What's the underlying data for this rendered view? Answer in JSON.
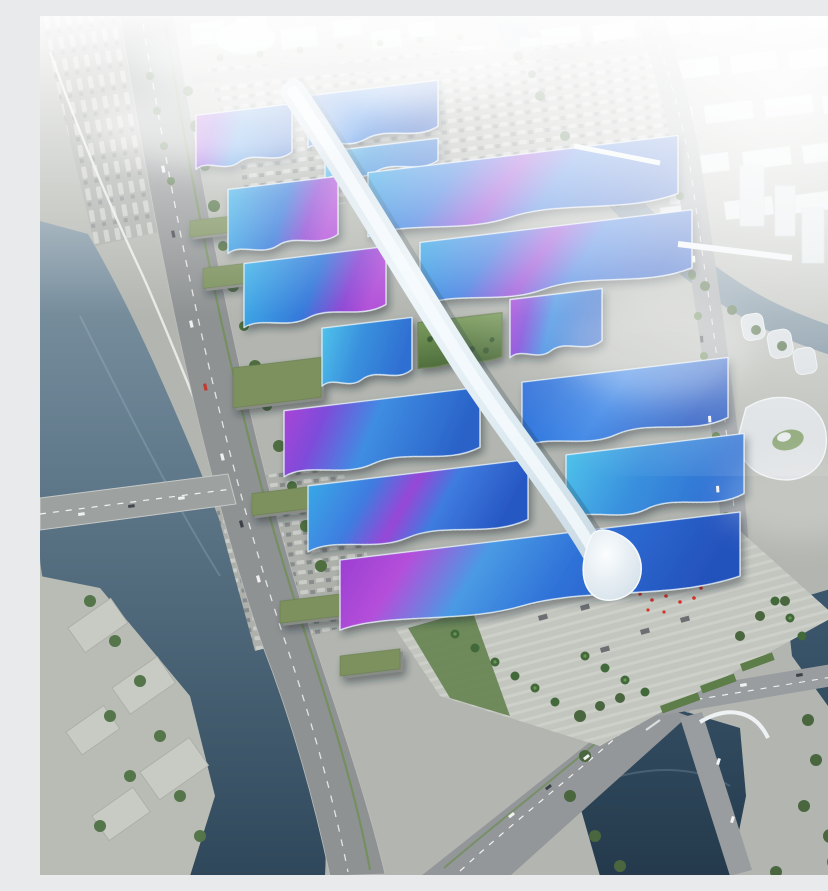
{
  "image": {
    "type": "architectural-aerial-rendering",
    "subject": "exhibition-convention-center-complex",
    "watermark": {
      "logo_text": "D"
    },
    "palette": {
      "roof_blue": "#2e6fd8",
      "roof_cyan": "#4fc2ea",
      "roof_purple": "#9c3fd2",
      "roof_magenta": "#b44fda",
      "spine_white": "#eef6fa",
      "ground_grey": "#b3b6b0",
      "road_grey": "#94979a",
      "water_river": "#6d8496",
      "water_dark": "#2c4254",
      "tree_green": "#4f6e3e",
      "courtyard_green": "#5f7f48",
      "haze_white": "#ffffff",
      "accent_red": "#d4342a"
    }
  }
}
